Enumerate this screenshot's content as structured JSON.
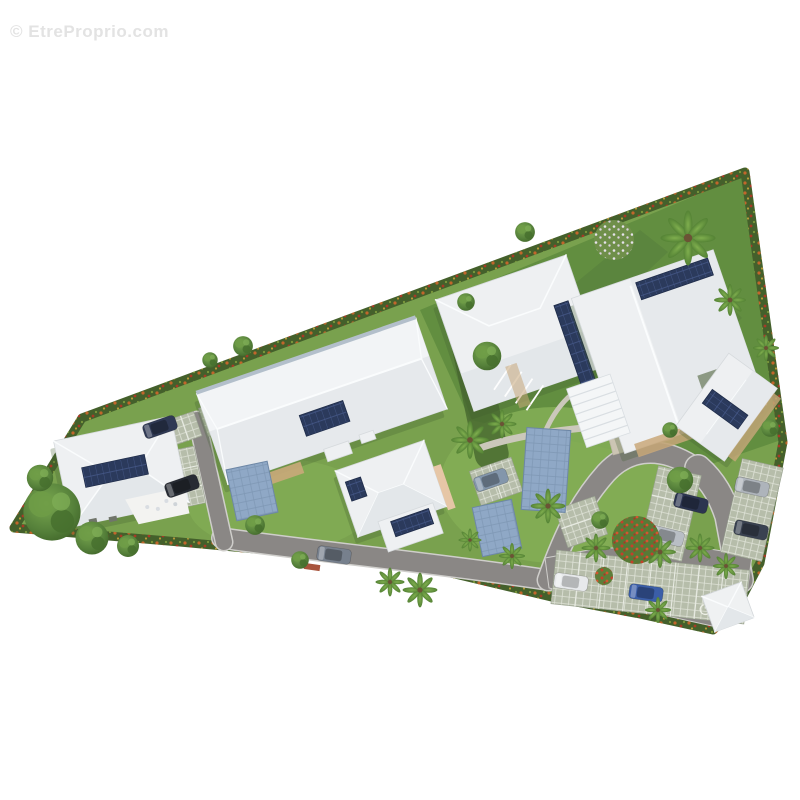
{
  "watermark": {
    "text": "© EtreProprio.com"
  },
  "scene": {
    "name": "residential-site-plan-aerial",
    "description": "Aerial 3D site plan rendering of a small residential development: white hip-roof buildings with rooftop solar panels, blue carports, parking bays with cars, winding grey access roads, bright lawns, palm trees, a flowering red tree and hedged site boundaries on a white background"
  },
  "palette": {
    "watermark_gray": "#e3e3e3",
    "grass": "#79a14e",
    "grass_dark": "#628e40",
    "lawn_bright": "#83ad55",
    "hedge": "#44602b",
    "hedge_accent_orange": "#c2662b",
    "hedge_accent_red": "#a83a26",
    "road": "#8a8785",
    "road_edge": "#cfcecb",
    "paver": "#b6bdaa",
    "paver_line": "#dfe3d8",
    "roof": "#eef0f2",
    "roof_shade": "#e3e7ea",
    "ridge": "#fafcfd",
    "solar_panel": "#2b3a5c",
    "solar_grid": "#46598a",
    "carport": "#8fa8c6",
    "deck": "#c9a87a",
    "patio": "#ccc5b4",
    "tree": "#4f7a33",
    "flowering_tree": "#c4402a",
    "shadow": "#3f5d2f"
  },
  "features": {
    "buildings": 6,
    "solar_arrays": 7,
    "carports": 3,
    "cars": 10,
    "labels": [
      "hip-roof-house",
      "long-apartment-building",
      "solar-panel-array",
      "blue-carport",
      "parking-bays",
      "palm-tree",
      "flowering-red-tree",
      "hedge-border",
      "access-road",
      "patio-pergola",
      "disabled-parking-spot"
    ]
  }
}
